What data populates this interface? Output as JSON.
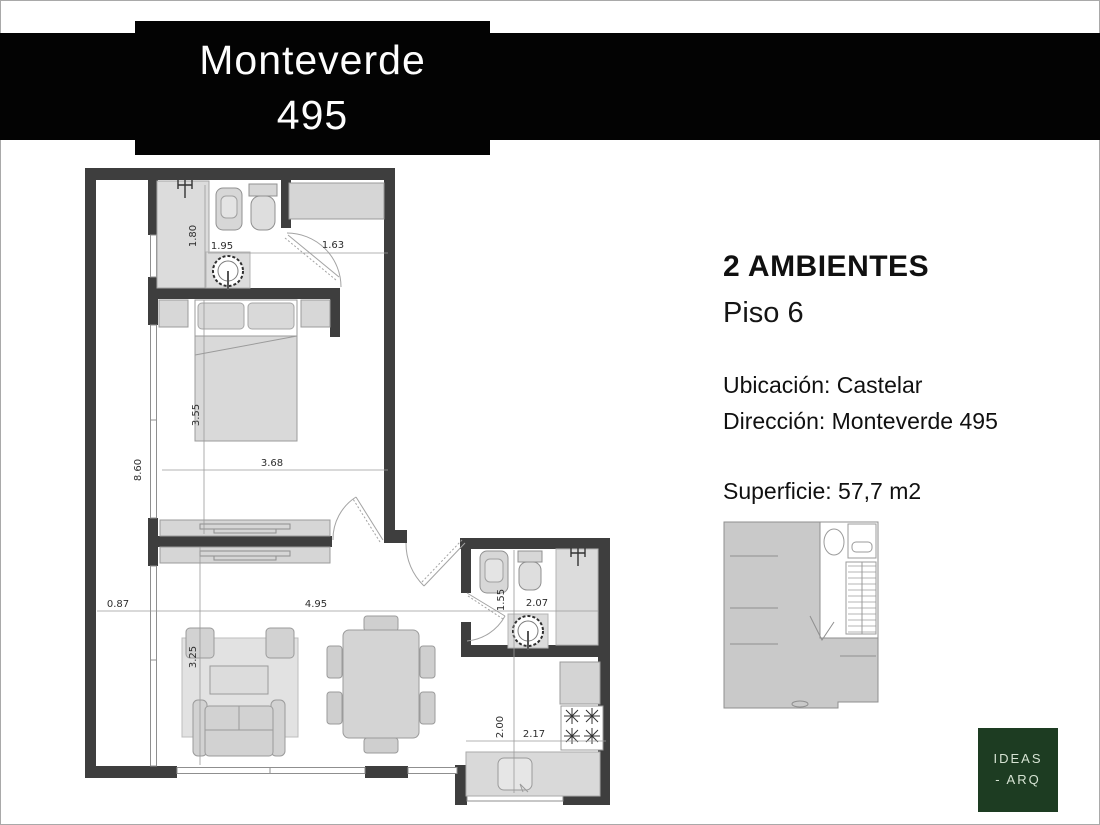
{
  "banner": {
    "line1": "Monteverde",
    "line2": "495",
    "bg": "#030303",
    "text_color": "#ffffff"
  },
  "info": {
    "rooms": "2 AMBIENTES",
    "floor": "Piso 6",
    "location": "Ubicación: Castelar",
    "address": "Dirección: Monteverde 495",
    "area": "Superficie: 57,7 m2"
  },
  "plan": {
    "dims": {
      "bath_h": "1.80",
      "bath_w": "1.95",
      "closet_w": "1.63",
      "bed_h": "3.55",
      "bed_w": "3.68",
      "balcony_l": "8.60",
      "balcony_w": "0.87",
      "living_w": "4.95",
      "living_h": "3.25",
      "wc_h": "1.55",
      "wc_w": "2.07",
      "kitchen_h": "2.00",
      "kitchen_w": "2.17"
    },
    "colors": {
      "wall": "#3e3e3e",
      "furniture": "#d7d7d7",
      "line": "#9b9b9b"
    }
  },
  "logo": {
    "line1": "IDEAS",
    "line2": "- ARQ",
    "bg": "#1d3c22"
  }
}
